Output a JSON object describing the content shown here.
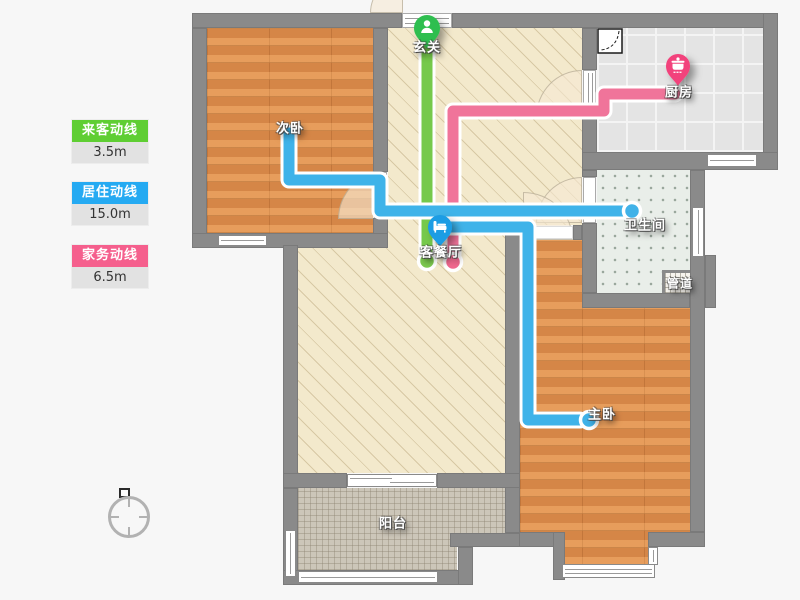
{
  "app": {
    "type": "floor-plan-route-viewer"
  },
  "legend": {
    "items": [
      {
        "label": "来客动线",
        "value": "3.5m",
        "color": "#5fce33"
      },
      {
        "label": "居住动线",
        "value": "15.0m",
        "color": "#25aaf2"
      },
      {
        "label": "家务动线",
        "value": "6.5m",
        "color": "#f55f8d"
      }
    ]
  },
  "rooms": {
    "foyer": {
      "label": "玄关"
    },
    "second_bedroom": {
      "label": "次卧"
    },
    "kitchen": {
      "label": "厨房"
    },
    "bathroom": {
      "label": "卫生间"
    },
    "living_dining": {
      "label": "客餐厅"
    },
    "duct": {
      "label": "管道"
    },
    "master_bedroom": {
      "label": "主卧"
    },
    "balcony": {
      "label": "阳台"
    }
  },
  "pins": [
    {
      "room": "foyer",
      "icon": "person-icon",
      "color": "#2fbe4f"
    },
    {
      "room": "kitchen",
      "icon": "cooking-pot-icon",
      "color": "#f2437b"
    },
    {
      "room": "living_dining",
      "icon": "sofa-icon",
      "color": "#1a9de4"
    }
  ],
  "lines": {
    "guest": {
      "name": "来客动线",
      "color": "#76c94b",
      "dot": "#7cc94f",
      "length": "3.5m"
    },
    "living": {
      "name": "居住动线",
      "color": "#3fb3e9",
      "dot": "#41b2e8",
      "length": "15.0m"
    },
    "housework": {
      "name": "家务动线",
      "color": "#f0749a",
      "dot": "#f0688f",
      "length": "6.5m"
    }
  }
}
